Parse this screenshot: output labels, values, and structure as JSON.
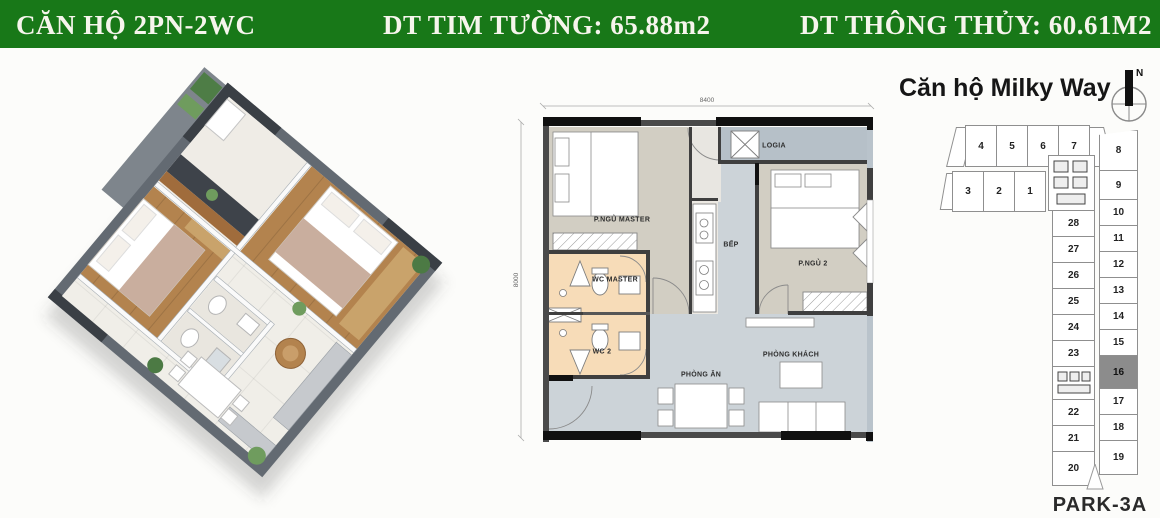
{
  "header": {
    "apartment_type": "CĂN HỘ 2PN-2WC",
    "wall_to_wall_area": "DT TIM TƯỜNG: 65.88m2",
    "clear_area": "DT THÔNG THỦY: 60.61M2",
    "bg_color": "#187818",
    "text_color": "#f6f5ec"
  },
  "floorplan": {
    "width_dim": "8400",
    "height_dim": "8000",
    "rooms": {
      "master_bedroom": "P.NGỦ MASTER",
      "logia": "LOGIA",
      "kitchen": "BẾP",
      "bedroom_2": "P.NGỦ 2",
      "wc_master": "WC MASTER",
      "wc_2": "WC 2",
      "dining_room": "PHÒNG ĂN",
      "living_room": "PHÒNG KHÁCH"
    },
    "colors": {
      "bedroom_floor": "#d2cec3",
      "wc_floor": "#f7dcb8",
      "living_floor": "#ccd3d8",
      "logia_floor": "#b6c0c8",
      "wall_dark": "#3f3f3f",
      "wall_black": "#111111"
    }
  },
  "keyplan": {
    "title": "Căn hộ Milky Way",
    "compass_north": "N",
    "tower_label": "PARK-3A",
    "top_row_units": [
      "4",
      "5",
      "6",
      "7"
    ],
    "second_row_units": [
      "3",
      "2",
      "1"
    ],
    "left_column_units": [
      "28",
      "27",
      "26",
      "25",
      "24",
      "23",
      "22",
      "21",
      "20"
    ],
    "right_column_units": [
      "8",
      "9",
      "10",
      "11",
      "12",
      "13",
      "14",
      "15",
      "16",
      "17",
      "18",
      "19"
    ],
    "highlighted_unit": "16",
    "highlight_color": "#8c8c8c"
  }
}
